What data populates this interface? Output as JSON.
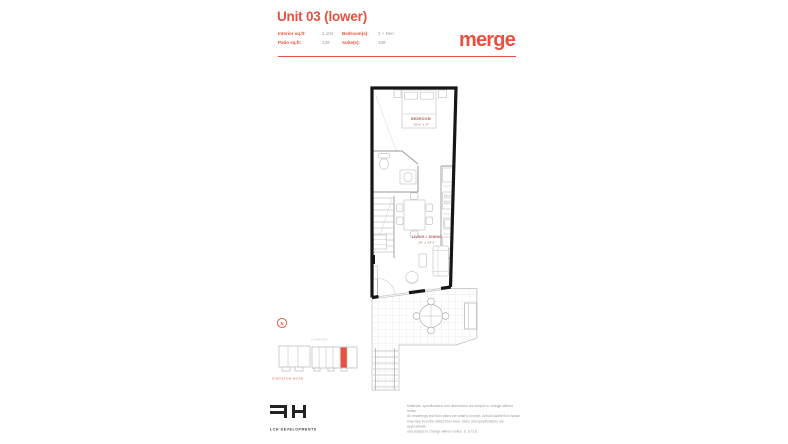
{
  "header": {
    "title": "Unit 03 (lower)",
    "brand": "merge",
    "accent_color": "#e8503f",
    "specs": [
      {
        "label": "Interior sq.ft:",
        "value": "1,104"
      },
      {
        "label": "Bedroom(s):",
        "value": "2 + Den"
      },
      {
        "label": "Patio sq.ft:",
        "value": "139"
      },
      {
        "label": "Suite(s):",
        "value": "108"
      }
    ]
  },
  "floorplan": {
    "wall_color": "#161616",
    "label_color": "#a8554c",
    "rooms": [
      {
        "name": "BEDROOM",
        "dim": "10'6\" x 9'"
      },
      {
        "name": "LIVING / DINING",
        "dim": "16' x 24'3\""
      }
    ]
  },
  "keyplan": {
    "compass_letter": "N",
    "street_top": "LANEWAY",
    "street_bottom": "KINGSTON ROAD",
    "highlight_color": "#e8503f"
  },
  "footer": {
    "developer": "LCH DEVELOPMENTS",
    "disclaimer": [
      "Materials, specifications and dimensions are subject to change without notice.",
      "All renderings and floor plans are artist's concept. Actual usable floor space",
      "may vary from the stated floor area. Sizes and specifications are approximate",
      "and subject to change without notice. E. & O.E."
    ]
  }
}
